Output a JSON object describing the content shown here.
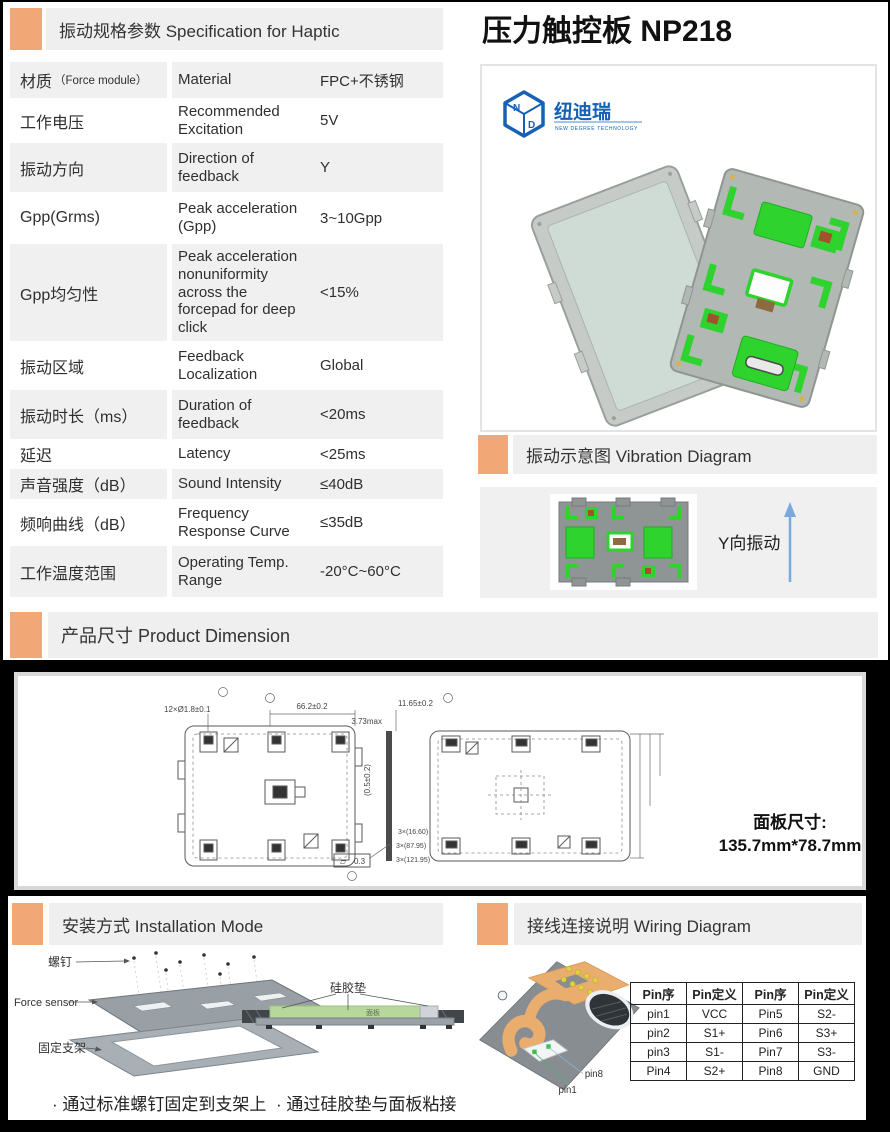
{
  "colors": {
    "accent": "#F2A777",
    "header_bg": "#EFEFEF",
    "row_gray": "#F0F0F0",
    "logo_blue": "#1660B5",
    "pad_green": "#2ED32E",
    "arrow_blue": "#7BA9DB",
    "fpc_orange": "#E9AD6E",
    "silicone_green": "#B7D89B"
  },
  "spec": {
    "title": "振动规格参数 Specification for Haptic",
    "rows": [
      {
        "cn": "材质",
        "cn_note": "（Force module）",
        "en": "Material",
        "value": "FPC+不锈钢"
      },
      {
        "cn": "工作电压",
        "en": "Recommended Excitation",
        "value": "5V"
      },
      {
        "cn": "振动方向",
        "en": "Direction of feedback",
        "value": "Y"
      },
      {
        "cn": "Gpp(Grms)",
        "en": "Peak acceleration (Gpp)",
        "value": "3~10Gpp"
      },
      {
        "cn": "Gpp均匀性",
        "en": "Peak acceleration nonuniformity across the forcepad for deep click",
        "value": "<15%"
      },
      {
        "cn": "振动区域",
        "en": "Feedback Localization",
        "value": "Global"
      },
      {
        "cn": "振动时长（ms）",
        "en": "Duration of feedback",
        "value": "<20ms"
      },
      {
        "cn": "延迟",
        "en": "Latency",
        "value": "<25ms"
      },
      {
        "cn": "声音强度（dB）",
        "en": "Sound Intensity",
        "value": "≤40dB"
      },
      {
        "cn": "频响曲线（dB）",
        "en": "Frequency Response Curve",
        "value": "≤35dB"
      },
      {
        "cn": "工作温度范围",
        "en": "Operating Temp. Range",
        "value": "-20°C~60°C"
      }
    ]
  },
  "product": {
    "title": "压力触控板 NP218",
    "logo_cn": "纽迪瑞",
    "logo_en": "NEW DEGREE TECHNOLOGY",
    "logo_letter_n": "N",
    "logo_letter_d": "D"
  },
  "vibration": {
    "title": "振动示意图 Vibration Diagram",
    "direction_label": "Y向振动"
  },
  "dimension": {
    "title": "产品尺寸 Product Dimension",
    "panel_label": "面板尺寸:",
    "panel_value": "135.7mm*78.7mm",
    "ann": {
      "a1": "12×Ø1.8±0.1",
      "a2": "66.2±0.2",
      "a3": "3.73max",
      "a4": "(0.5±0.2)",
      "a5": "3×(16.60)",
      "a6": "3×(87.95)",
      "a7": "3×(121.95)",
      "a8": "11.65±0.2",
      "a9": "0.3",
      "flat_sym": "▱"
    }
  },
  "installation": {
    "title": "安装方式 Installation Mode",
    "label_screw": "螺钉",
    "label_force_sensor": "Force sensor",
    "label_bracket": "固定支架",
    "label_silicone": "硅胶垫",
    "label_panel": "面板",
    "caption_left": "· 通过标准螺钉固定到支架上",
    "caption_right": "· 通过硅胶垫与面板粘接"
  },
  "wiring": {
    "title": "接线连接说明 Wiring Diagram",
    "pin1_label": "pin1",
    "pin8_label": "pin8",
    "table": {
      "headers": [
        "Pin序",
        "Pin定义",
        "Pin序",
        "Pin定义"
      ],
      "rows": [
        [
          "pin1",
          "VCC",
          "Pin5",
          "S2-"
        ],
        [
          "pin2",
          "S1+",
          "Pin6",
          "S3+"
        ],
        [
          "pin3",
          "S1-",
          "Pin7",
          "S3-"
        ],
        [
          "Pin4",
          "S2+",
          "Pin8",
          "GND"
        ]
      ]
    }
  }
}
